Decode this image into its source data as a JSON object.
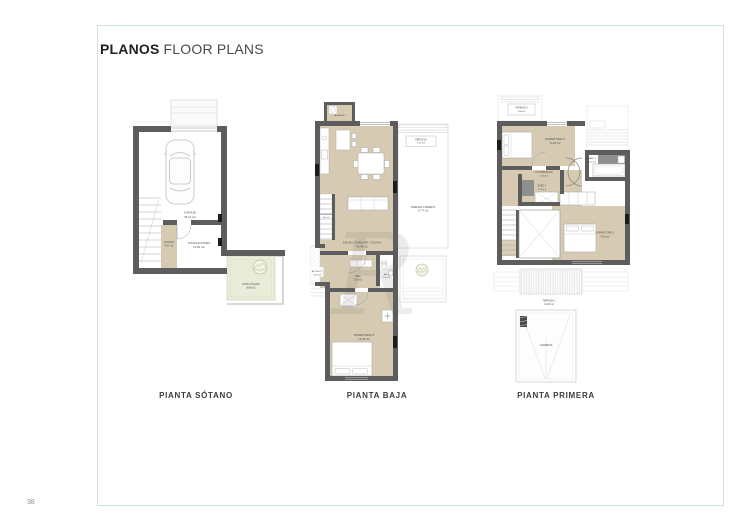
{
  "header": {
    "title_bold": "PLANOS",
    "title_regular": "FLOOR PLANS"
  },
  "footer": {
    "page_number": "38"
  },
  "watermark": {
    "letter": "R"
  },
  "colors": {
    "wall": "#5d5d5d",
    "floor_beige": "#d6cbb2",
    "patio_green": "#e8ecd9",
    "frame_border": "#cfe0e3",
    "tile_dark": "#8f8f8f"
  },
  "plans": {
    "sotano": {
      "caption": "PIANTA SÓTANO",
      "rooms": {
        "garaje": {
          "name": "GARAJE",
          "area": "35.14 m2"
        },
        "acceso": {
          "name": "ACCESO",
          "area": "4.67 m2"
        },
        "instalaciones": {
          "name": "INSTALACIONES",
          "area": "14.60 m2"
        },
        "patio_ingles": {
          "name": "PATIO INGLÉS",
          "area": "8.85 m2"
        }
      }
    },
    "baja": {
      "caption": "PIANTA BAJA",
      "rooms": {
        "lavadero": {
          "name": "LAVADERO"
        },
        "pergola": {
          "name": "PÉRGOLA",
          "area": "4.09 m2"
        },
        "terraza_cubierta": {
          "name": "TERRAZA CUBIERTA",
          "area": "17.77 m2"
        },
        "escalera": {
          "name": "ESCALERA",
          "area": "4.02 m2"
        },
        "salon": {
          "name": "SALÓN COMEDOR - COCINA",
          "area": "43.48 m2"
        },
        "acceso1": {
          "name": "ACCESO 1",
          "area": "3.48 m2"
        },
        "hall": {
          "name": "HALL",
          "area": "3.93 m2"
        },
        "aseo": {
          "name": "ASEO",
          "area": "2.08 m2"
        },
        "dormitorio3": {
          "name": "DORMITORIO 3",
          "area": "13.36 m2"
        }
      }
    },
    "primera": {
      "caption": "PIANTA PRIMERA",
      "rooms": {
        "terraza2": {
          "name": "TERRAZA 2",
          "area": "3.06 m2"
        },
        "dormitorio2": {
          "name": "DORMITORIO 2",
          "area": "14.28 m2"
        },
        "bano2": {
          "name": "BAÑO 2",
          "area": "4.13 m2"
        },
        "distribuidor": {
          "name": "DISTRIBUIDOR",
          "area": "6.09 m2"
        },
        "bano1": {
          "name": "BAÑO 1",
          "area": "3.46 m2"
        },
        "dormitorio1": {
          "name": "DORMITORIO 1",
          "area": "8.60 m2"
        },
        "terraza1": {
          "name": "TERRAZA 1",
          "area": "12.20 m2"
        },
        "cubierta": {
          "name": "CUBIERTA"
        }
      }
    }
  }
}
